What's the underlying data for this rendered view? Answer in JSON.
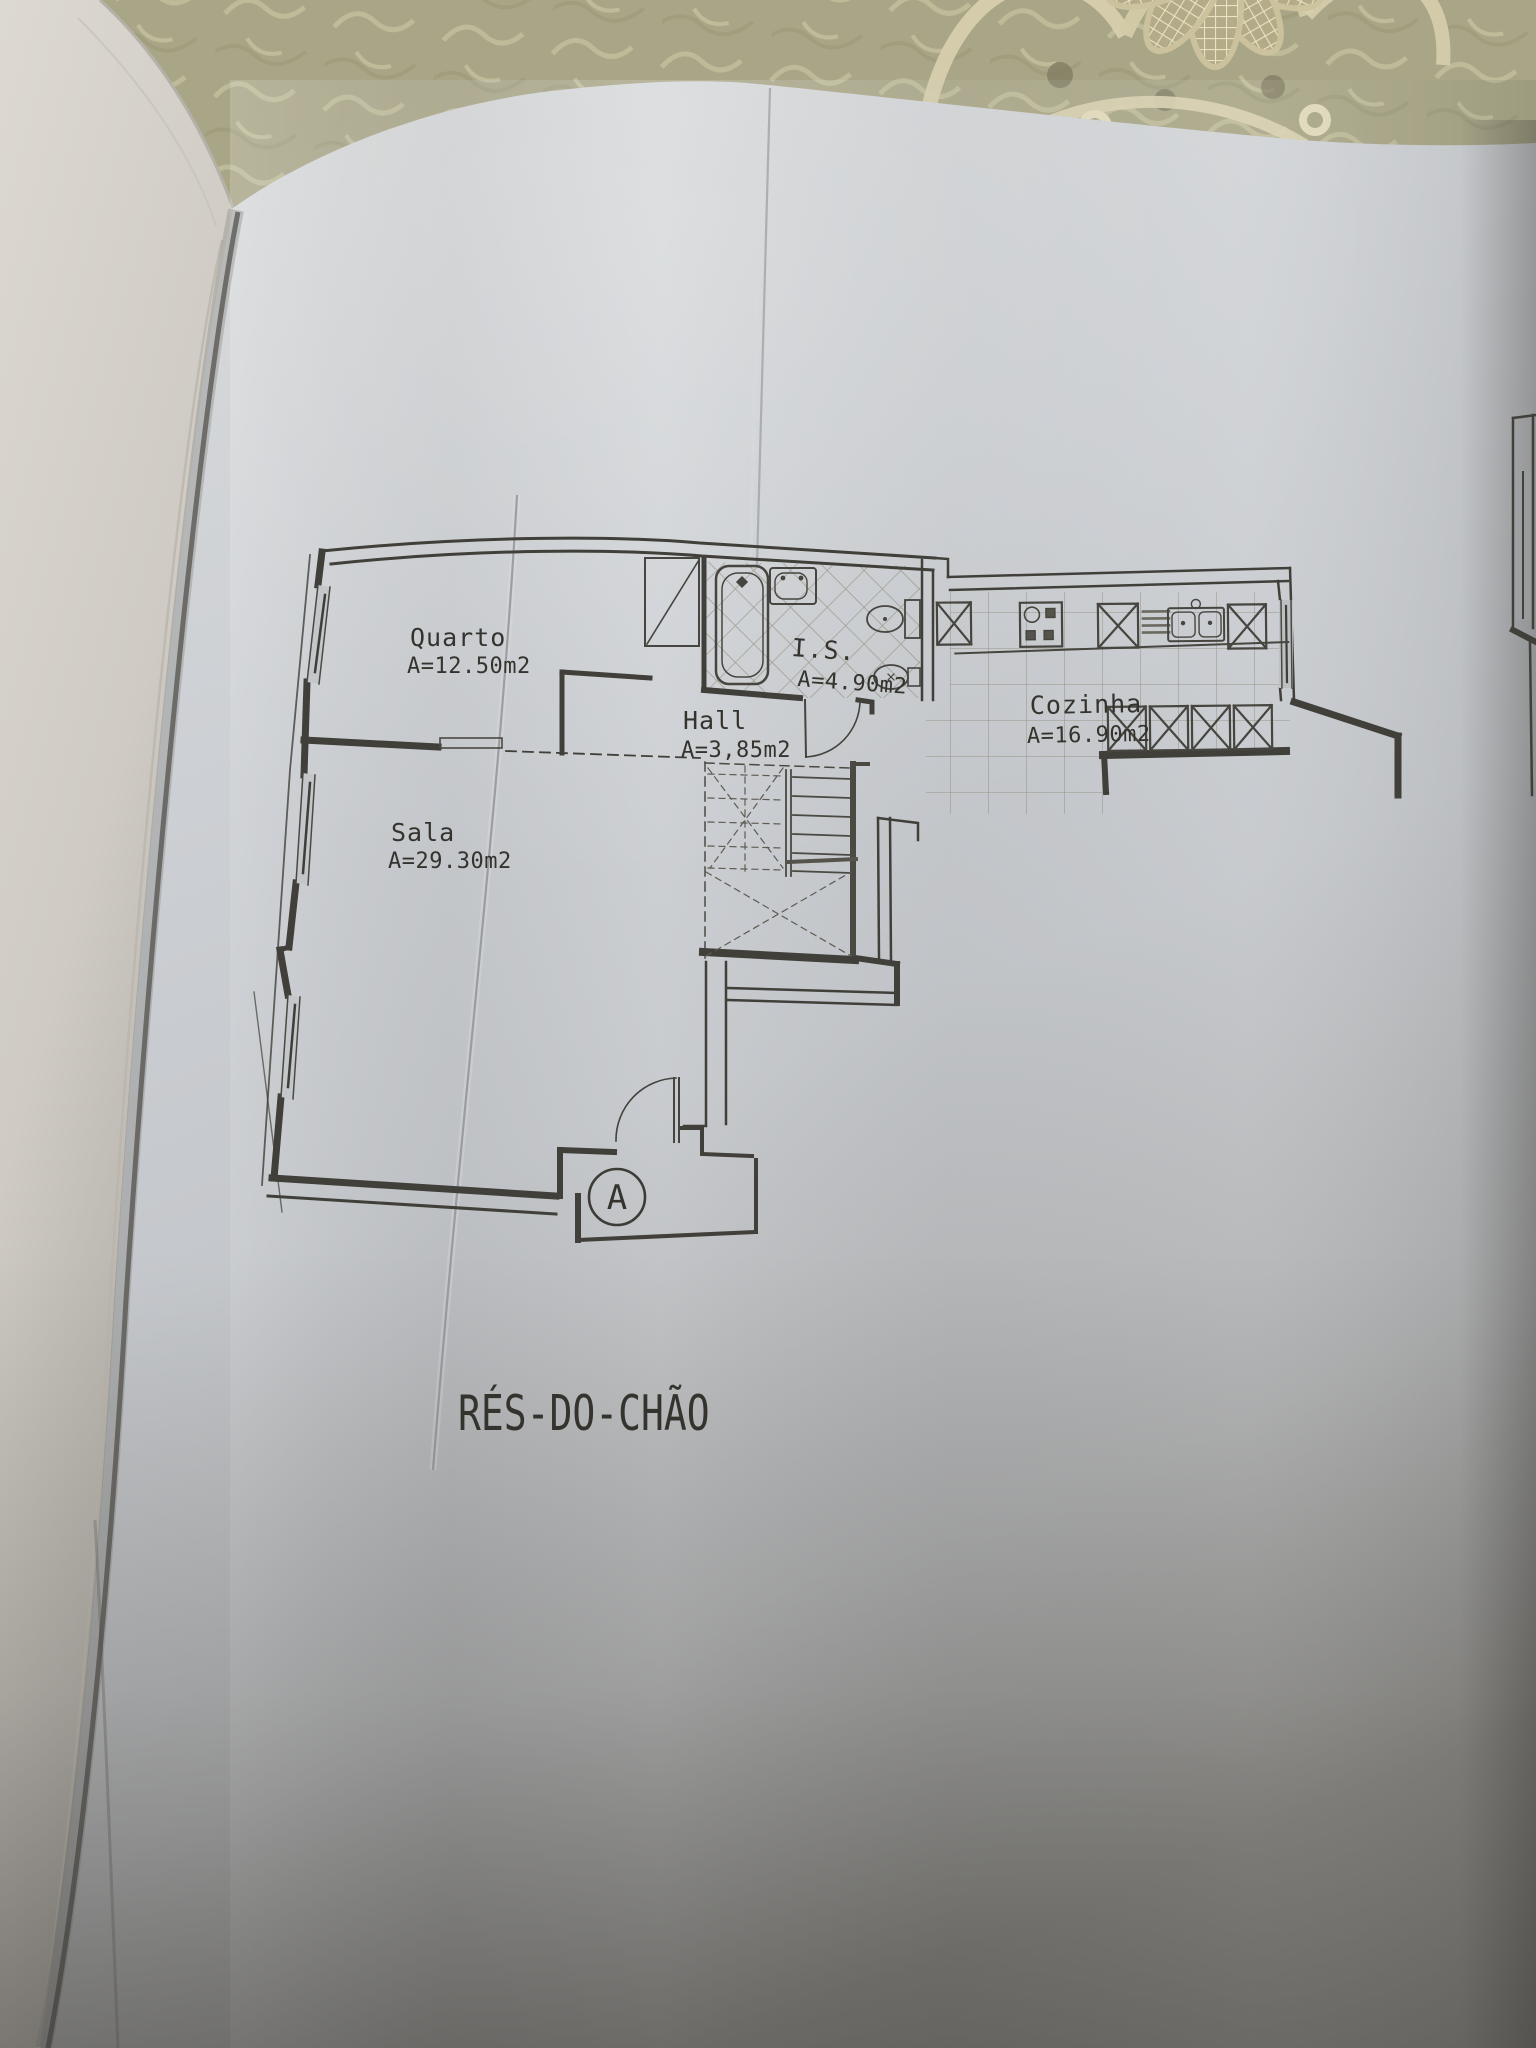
{
  "floor_plan": {
    "title": "RÉS-DO-CHÃO",
    "section_marker": "A",
    "rooms": [
      {
        "name": "Quarto",
        "area": "A=12.50m2"
      },
      {
        "name": "Sala",
        "area": "A=29.30m2"
      },
      {
        "name": "Hall",
        "area": "A=3,85m2"
      },
      {
        "name": "I.S.",
        "area": "A=4.90m2"
      },
      {
        "name": "Cozinha",
        "area": "A=16.90m2"
      }
    ],
    "fixtures": [
      "bathtub",
      "washbasin",
      "toilet",
      "bidet",
      "wardrobe",
      "stove",
      "double-sink",
      "stairs",
      "entry-door",
      "windows"
    ],
    "colors": {
      "paper": "#cbced2",
      "ink": "#3c3b36",
      "tablecloth": "#a9a687",
      "lace": "#d8cfad",
      "left_pages": "#dad6cf"
    }
  }
}
